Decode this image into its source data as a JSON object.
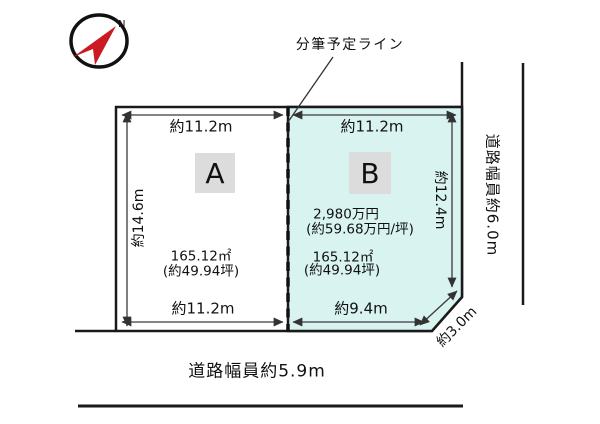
{
  "compass": {
    "north_label": "N"
  },
  "annotations": {
    "subdivision_line_label": "分筆予定ライン"
  },
  "plots": {
    "a": {
      "label": "A",
      "dim_top": "約11.2m",
      "dim_left": "約14.6m",
      "dim_bottom": "約11.2m",
      "area_sqm": "165.12㎡",
      "area_tsubo": "(約49.94坪)"
    },
    "b": {
      "label": "B",
      "dim_top": "約11.2m",
      "dim_right": "約12.4m",
      "dim_bottom": "約9.4m",
      "dim_diagonal": "約3.0m",
      "price": "2,980万円",
      "price_per_tsubo": "(約59.68万円/坪)",
      "area_sqm": "165.12㎡",
      "area_tsubo": "(約49.94坪)"
    }
  },
  "roads": {
    "right_width_label": "道路幅員約6.0m",
    "bottom_width_label": "道路幅員約5.9m"
  },
  "colors": {
    "plot_b_fill": "#d8f3f0",
    "label_box_fill": "#dcdcdc",
    "line": "#1a1a1a",
    "compass_red": "#cc1a22"
  }
}
